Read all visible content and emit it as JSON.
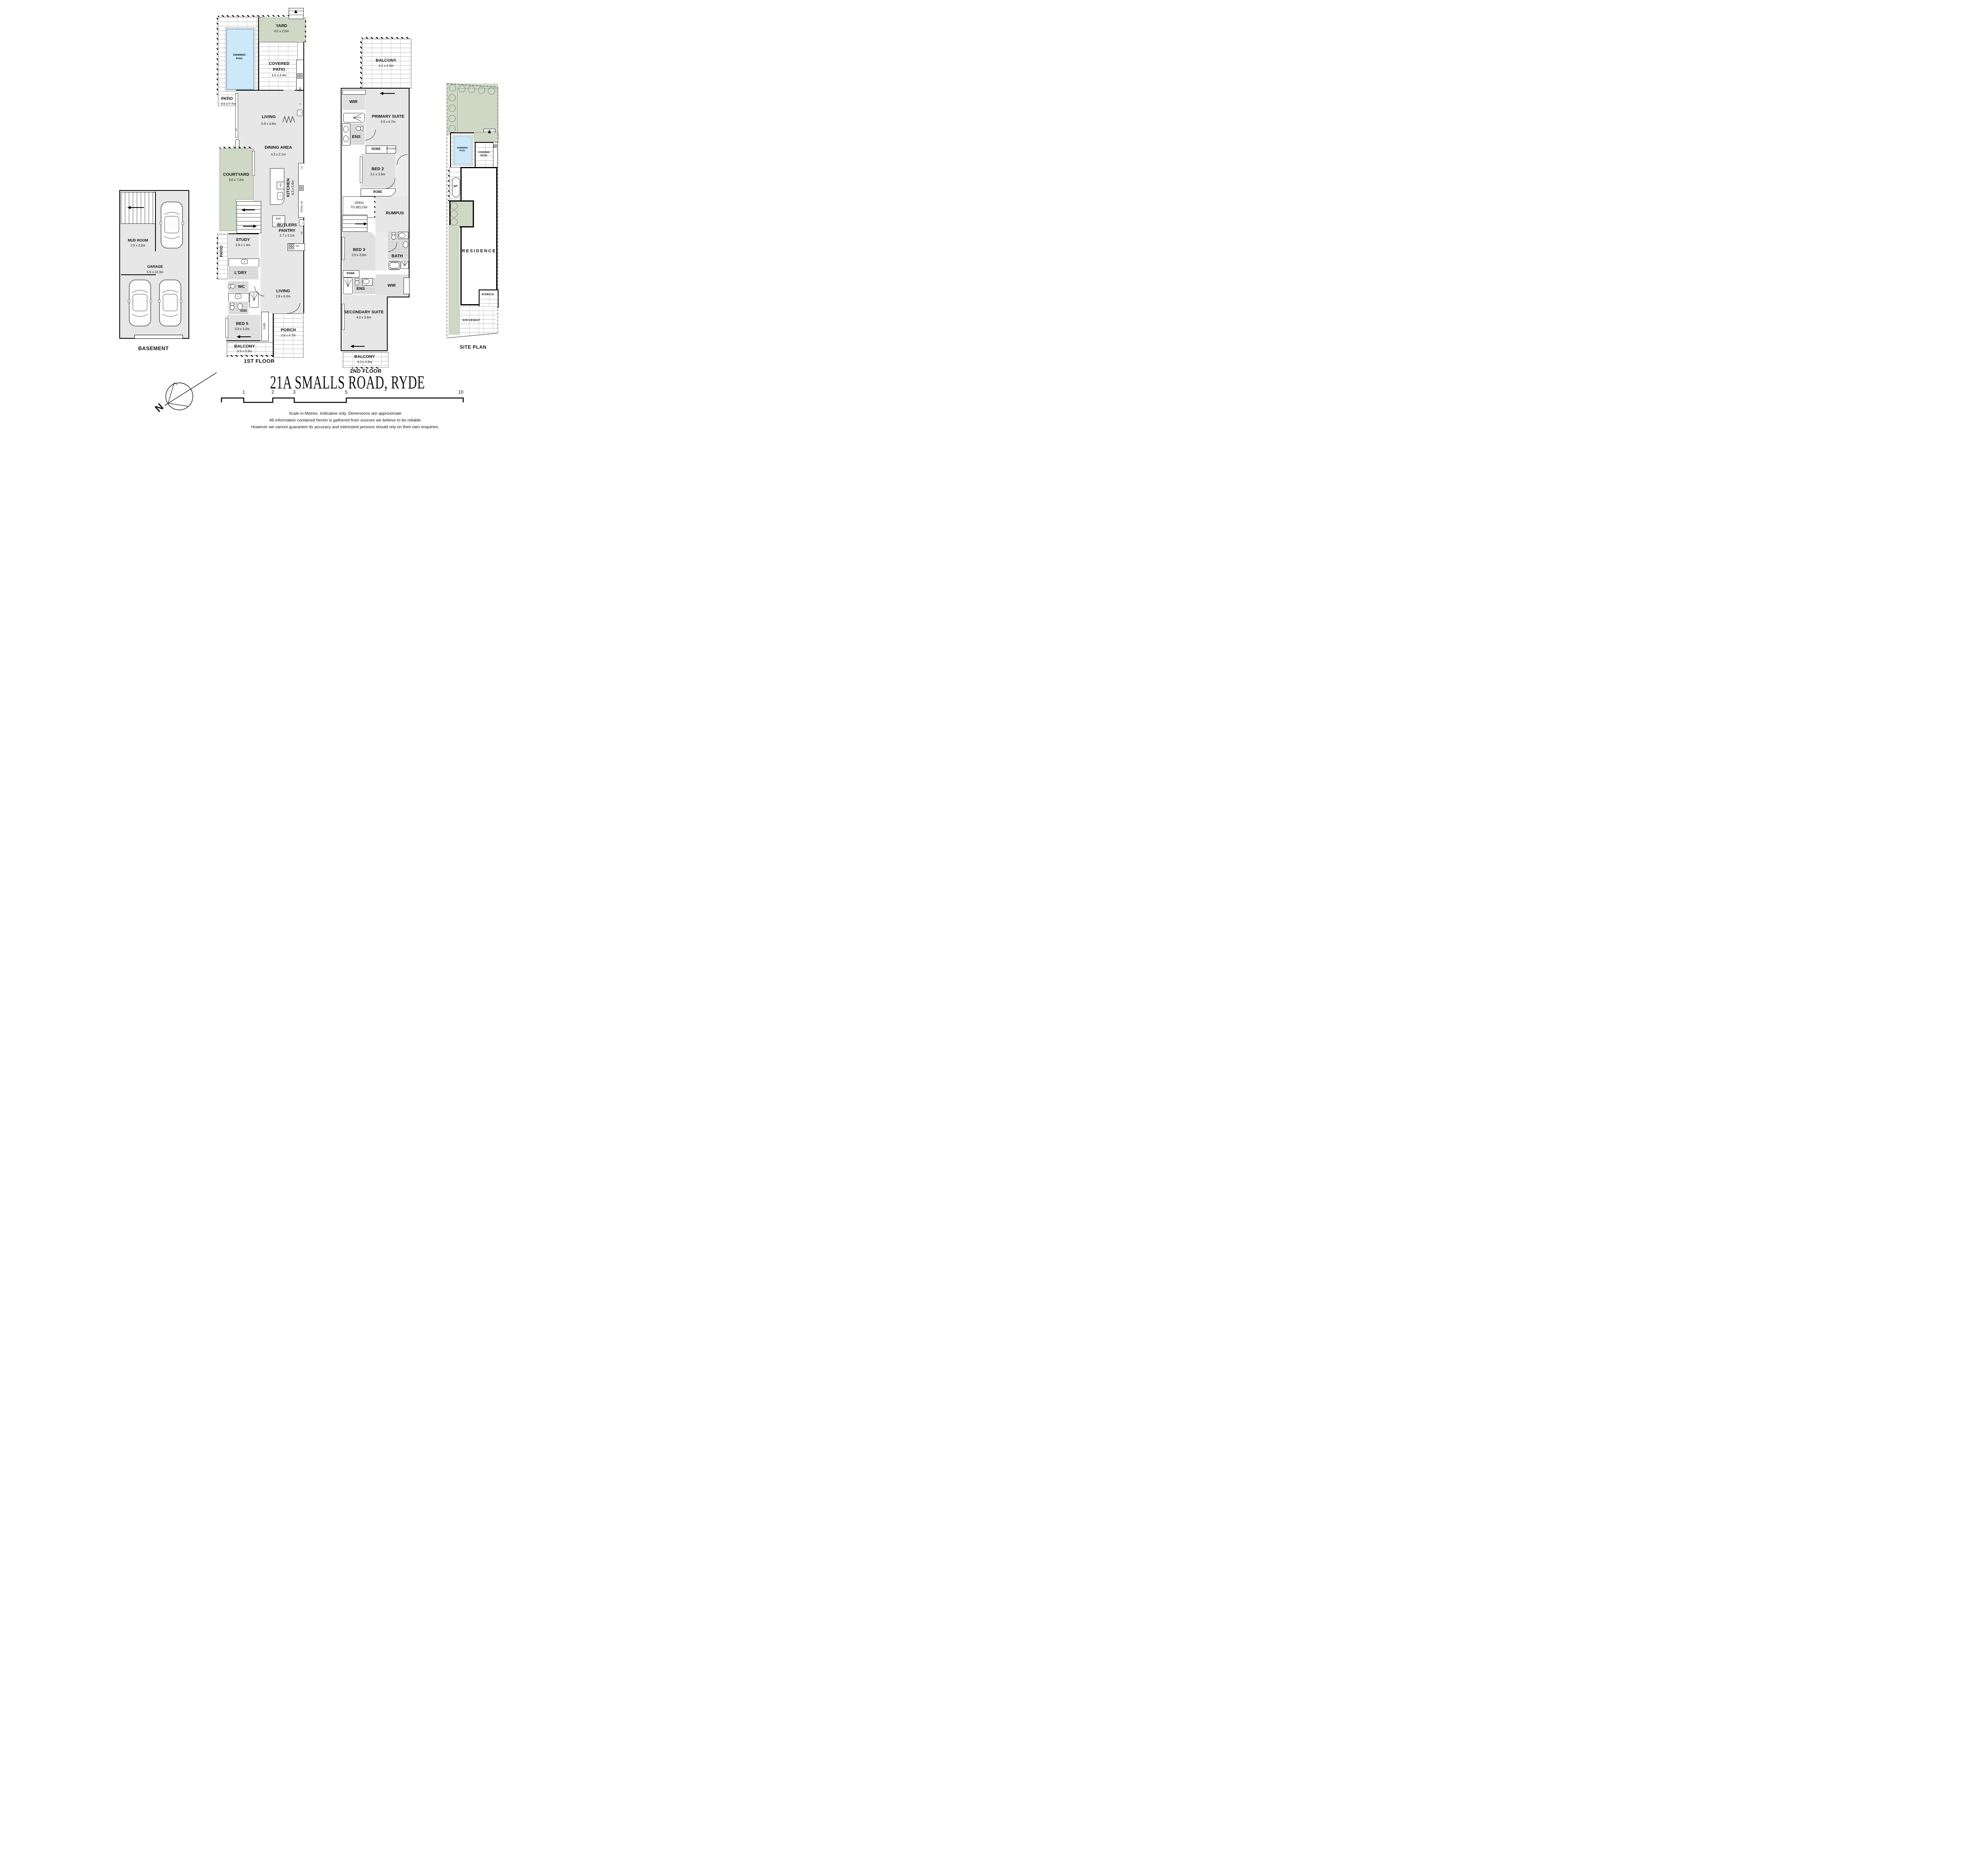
{
  "title": "21A SMALLS ROAD, RYDE",
  "colors": {
    "room_fill": "#e7e7e7",
    "wet_fill": "#d6d6d6",
    "green": "#cfd8c5",
    "pool_blue": "#cde9f9",
    "wall": "#000000"
  },
  "floor_labels": {
    "basement": "BASEMENT",
    "first": "1ST FLOOR",
    "second": "2ND FLOOR",
    "site": "SITE PLAN"
  },
  "basement": {
    "mud_room": {
      "name": "MUD ROOM",
      "dims": "2.5 x 2.0m"
    },
    "garage": {
      "name": "GARAGE",
      "dims": "5.9 x 12.3m"
    }
  },
  "first_floor": {
    "patio_top": {
      "name": "PATIO",
      "dims": "3.5 x 7.7m"
    },
    "swimming_pool": {
      "line1": "SWIMMING",
      "line2": "POOL"
    },
    "yard": {
      "name": "YARD",
      "dims": "4.0 x 2.0m"
    },
    "covered_patio": {
      "line1": "COVERED",
      "line2": "PATIO",
      "dims": "4.0 x 4.4m"
    },
    "living": {
      "name": "LIVING",
      "dims": "5.9 x 4.9m"
    },
    "dining": {
      "name": "DINING AREA",
      "dims": "4.3 x 2.1m"
    },
    "courtyard": {
      "name": "COURTYARD",
      "dims": "3.0 x 7.2m"
    },
    "kitchen": {
      "name": "KITCHEN",
      "dims": "4.3 x 5.6m"
    },
    "butlers": {
      "line1": "BUTLERS",
      "line2": "PANTRY",
      "dims": "2.7 x 3.1m"
    },
    "study": {
      "name": "STUDY",
      "dims": "2.8 x 1.4m"
    },
    "patio_side": {
      "name": "PATIO"
    },
    "ldry": {
      "name": "L'DRY"
    },
    "wc": {
      "name": "WC"
    },
    "ens": {
      "name": "ENS"
    },
    "living2": {
      "name": "LIVING",
      "dims": "2.8 x 6.0m"
    },
    "bed5": {
      "name": "BED 5",
      "dims": "3.9 x 3.2m"
    },
    "robe": {
      "name": "ROBE"
    },
    "porch": {
      "name": "PORCH",
      "dims": "2.6 x 4.7m"
    },
    "balcony": {
      "name": "BALCONY",
      "dims": "3.9 x 0.9m"
    },
    "fixtures": {
      "fp": "FP",
      "bbq": "BBQ",
      "f": "F",
      "ov": "OV",
      "dw": "DW",
      "int_fridge": "INT FRIDGE",
      "bar": "BAR",
      "f2": "F",
      "ov2": "OV",
      "dw2": "DW"
    }
  },
  "second_floor": {
    "balcony_top": {
      "name": "BALCONY",
      "dims": "4.1 x 4.3m"
    },
    "wir": {
      "name": "WIR"
    },
    "primary": {
      "name": "PRIMARY SUITE",
      "dims": "3.9 x 6.7m"
    },
    "ens": {
      "name": "ENS"
    },
    "robe": {
      "name": "ROBE"
    },
    "dresser": {
      "name": "DRESSER"
    },
    "bed2": {
      "name": "BED 2",
      "dims": "3.1 x 3.6m"
    },
    "robe2": {
      "name": "ROBE"
    },
    "open_below": {
      "line1": "OPEN",
      "line2": "TO BELOW"
    },
    "rumpus": {
      "name": "RUMPUS"
    },
    "bed3": {
      "name": "BED 3",
      "dims": "2.9 x 3.9m"
    },
    "bath": {
      "name": "BATH"
    },
    "robe3": {
      "name": "ROBE"
    },
    "ens2": {
      "name": "ENS"
    },
    "wir2": {
      "name": "WIR"
    },
    "secondary": {
      "name": "SECONDARY SUITE",
      "dims": "4.0 x 3.6m"
    },
    "balcony2": {
      "name": "BALCONY",
      "dims": "4.0 x 0.9m"
    }
  },
  "site_plan": {
    "swimming_pool": {
      "line1": "SWIMMING",
      "line2": "POOL"
    },
    "covered_patio": {
      "line1": "COVERED",
      "line2": "PATIO"
    },
    "wt": {
      "name": "WT"
    },
    "residence": {
      "name": "RESIDENCE"
    },
    "porch": {
      "name": "PORCH"
    },
    "driveway": {
      "name": "DRIVEWAY"
    }
  },
  "compass": {
    "north": "N"
  },
  "scale_bar": {
    "ticks": [
      "1",
      "2",
      "3",
      "5",
      "10"
    ]
  },
  "disclaimer": {
    "line1": "Scale in Metres. Indicative only. Dimensions are approximate",
    "line2": "All information contained herein is gathered from sources we believe to be reliable",
    "line3": "However we cannot guarantee its accuracy and interested persons should rely on their own enquiries."
  }
}
